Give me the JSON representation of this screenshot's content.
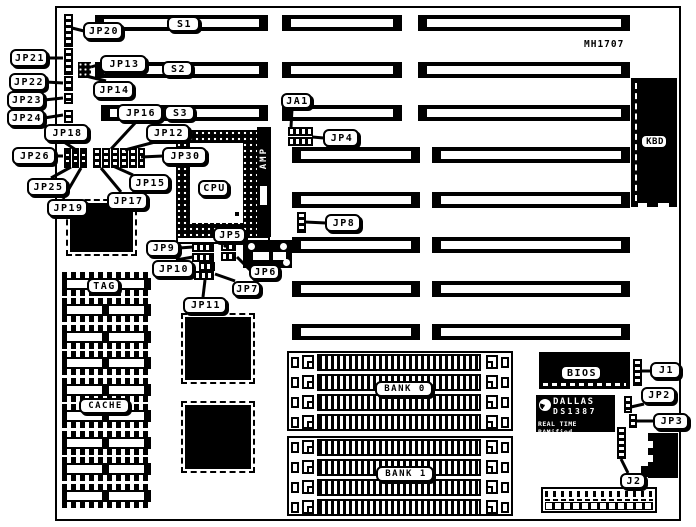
{
  "board": {
    "model": "MH1707"
  },
  "callouts": {
    "jp20": "JP20",
    "jp21": "JP21",
    "jp22": "JP22",
    "jp23": "JP23",
    "jp24": "JP24",
    "jp13": "JP13",
    "jp14": "JP14",
    "jp16": "JP16",
    "jp18": "JP18",
    "jp12": "JP12",
    "jp26": "JP26",
    "jp30": "JP30",
    "jp25": "JP25",
    "jp15": "JP15",
    "jp19": "JP19",
    "jp17": "JP17",
    "ja1": "JA1",
    "jp4": "JP4",
    "jp8": "JP8",
    "jp5": "JP5",
    "jp9": "JP9",
    "jp10": "JP10",
    "jp6": "JP6",
    "jp11": "JP11",
    "jp7": "JP7",
    "s1": "S1",
    "s2": "S2",
    "s3": "S3",
    "cpu": "CPU",
    "kbd": "KBD",
    "tag": "TAG",
    "cache": "CACHE",
    "bank0": "BANK 0",
    "bank1": "BANK 1",
    "bios": "BIOS",
    "j1": "J1",
    "jp2": "JP2",
    "jp3": "JP3",
    "j2": "J2"
  },
  "chips": {
    "amp": {
      "label": "AMP"
    },
    "dallas": {
      "brand": "DALLAS",
      "part": "DS1387",
      "tagline": "REAL TIME RAMified"
    }
  }
}
